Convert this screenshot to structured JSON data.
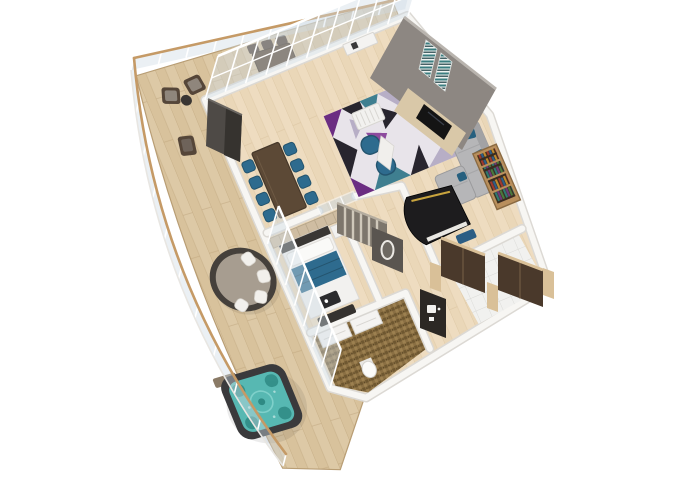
{
  "scene": {
    "type": "3d-isometric-floor-plan",
    "title": "3D floor plan of a luxury suite with wrap-around terrace, hot tub, grand piano, living-dining room, bedroom and bathroom",
    "background": "#ffffff",
    "rooms": [
      {
        "name": "wraparound-terrace",
        "floor": "wood-deck",
        "furniture": [
          "glass-balustrade",
          "two-cube-armchairs",
          "round-side-table",
          "lounge-chair",
          "round-daybed-with-cushions",
          "square-hot-tub",
          "hot-tub-step-mat"
        ]
      },
      {
        "name": "balcony-dining",
        "floor": "wood-deck",
        "furniture": [
          "outdoor-dining-table",
          "six-outdoor-chairs"
        ]
      },
      {
        "name": "dining-room",
        "floor": "light-wood",
        "furniture": [
          "long-dining-table",
          "eight-blue-chairs",
          "dark-tv-cabinet",
          "glass-partition"
        ]
      },
      {
        "name": "living-room",
        "floor": "light-wood",
        "furniture": [
          "geometric-area-rug",
          "two-blue-armchairs",
          "slatted-coffee-table",
          "white-sideboard",
          "gray-sectional-sofa",
          "blue-pillows",
          "media-wall-with-tv-and-fireplace",
          "two-wall-art-panels",
          "grand-piano",
          "piano-bench",
          "bookshelf"
        ]
      },
      {
        "name": "bedroom",
        "floor": "light-wood",
        "furniture": [
          "tufted-headboard-wall",
          "bed-with-blue-runner",
          "breakfast-tray",
          "foot-bench",
          "nightstand",
          "floor-to-ceiling-windows"
        ]
      },
      {
        "name": "dressing-area",
        "floor": "light-wood",
        "furniture": [
          "sliding-door-wardrobe",
          "dark-wall-with-oval-mirror"
        ]
      },
      {
        "name": "bathroom",
        "floor": "brown-mosaic",
        "furniture": [
          "double-vanity",
          "toilet"
        ]
      },
      {
        "name": "entry-hall",
        "floor": "white-tile",
        "furniture": [
          "dark-wardrobe-closets",
          "beige-trim-pillars",
          "minibar-console-with-coffee-machine"
        ]
      }
    ],
    "colors": {
      "bg": "#ffffff",
      "deck_wood": "#d8c29c",
      "deck_wood_light": "#e2cfae",
      "deck_seam": "#b89d74",
      "interior_wood": "#ead7b8",
      "interior_wood_light": "#f2e2c8",
      "wood_seam": "#cdb48c",
      "wall_white": "#f7f6f3",
      "wall_edge": "#dcd9d4",
      "wall_gray": "#8d8782",
      "wall_dark": "#57524d",
      "glass_tint": "#cfdbe4",
      "frame_white": "#fafafa",
      "wood_cap": "#c59a66",
      "table_brown": "#5c4936",
      "chair_blue": "#2e6b8e",
      "chair_blue_dark": "#24546e",
      "sofa_gray": "#b6b6b8",
      "sofa_gray_dark": "#a2a2a4",
      "pillow_blue": "#27607f",
      "rug_base": "#e8e4ea",
      "rug_purple": "#6b2d82",
      "rug_purple2": "#8d4a9e",
      "rug_dark": "#28252e",
      "rug_gray": "#b7aec6",
      "rug_slate": "#524a5e",
      "rug_teal": "#3f7f90",
      "piano_black": "#1d1c1e",
      "piano_gold": "#c8a43e",
      "bench_blue": "#2b5d84",
      "hottub_shell": "#3a3a3c",
      "hottub_water": "#57b8b2",
      "hottub_water_dark": "#2f8a84",
      "daybed_rim": "#45403b",
      "daybed_top": "#a79d90",
      "cushion_white": "#f2f0ec",
      "mosaic_a": "#8a6f43",
      "mosaic_b": "#6e5730",
      "mosaic_c": "#9c8050",
      "tile_white": "#f1f1ef",
      "tile_line": "#d9d9d6",
      "wardrobe_brown": "#4a392b",
      "trim_beige": "#d9c098",
      "headboard_beige": "#cfbda2",
      "bed_white": "#f2f1ef",
      "bed_blue": "#2e6b8e",
      "outdoor_wood": "#554639",
      "outdoor_cushion": "#8f867c",
      "art_teal": "#3b7d80",
      "art_dark": "#1d3f44",
      "fireplace_cream": "#d9c8a8",
      "tv_black": "#141414",
      "shelf_wood": "#b98f5c",
      "book_red": "#a03a2e",
      "book_blue": "#2e5f8a",
      "book_gold": "#c08a2e",
      "book_teal": "#2f7a72",
      "book_purple": "#703a7a",
      "book_green": "#4a7a3e"
    }
  }
}
